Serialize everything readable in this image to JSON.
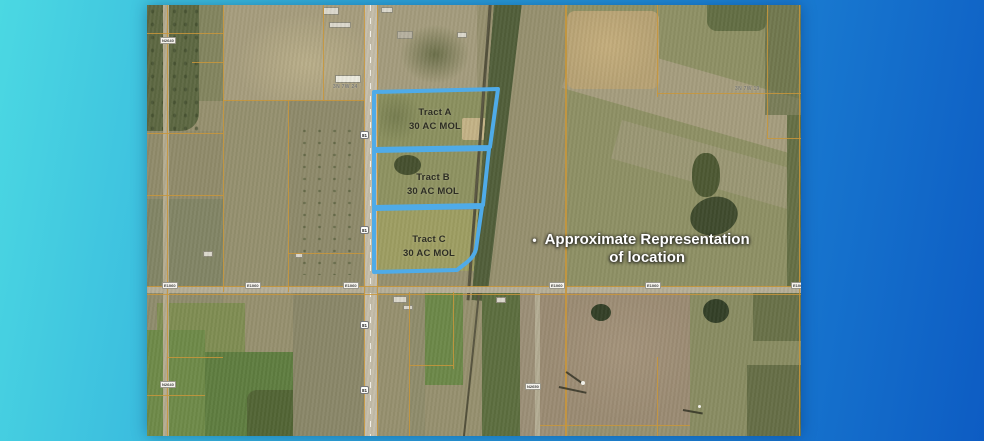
{
  "colors": {
    "bg_start": "#4bd8e2",
    "bg_mid": "#2fa9dc",
    "bg_end": "#0d5cc3",
    "tract_outline": "#4fabe8",
    "parcel_line": "#c9973b",
    "annotation_text": "#ffffff",
    "tract_label_text": "#2e2e24"
  },
  "map": {
    "tracts": [
      {
        "name": "Tract A",
        "acreage": "30 AC MOL"
      },
      {
        "name": "Tract B",
        "acreage": "30 AC MOL"
      },
      {
        "name": "Tract C",
        "acreage": "30 AC MOL"
      }
    ],
    "annotation": {
      "bullet": "•",
      "line1": "Approximate Representation",
      "line2": "of location"
    },
    "township_labels": {
      "left": "3N 7W 24",
      "right": "3N 7W 19"
    },
    "road_labels": {
      "ns_left": "N2640",
      "ns_mid": "N2650",
      "ew": "E1060",
      "highway_shield": "81"
    }
  }
}
